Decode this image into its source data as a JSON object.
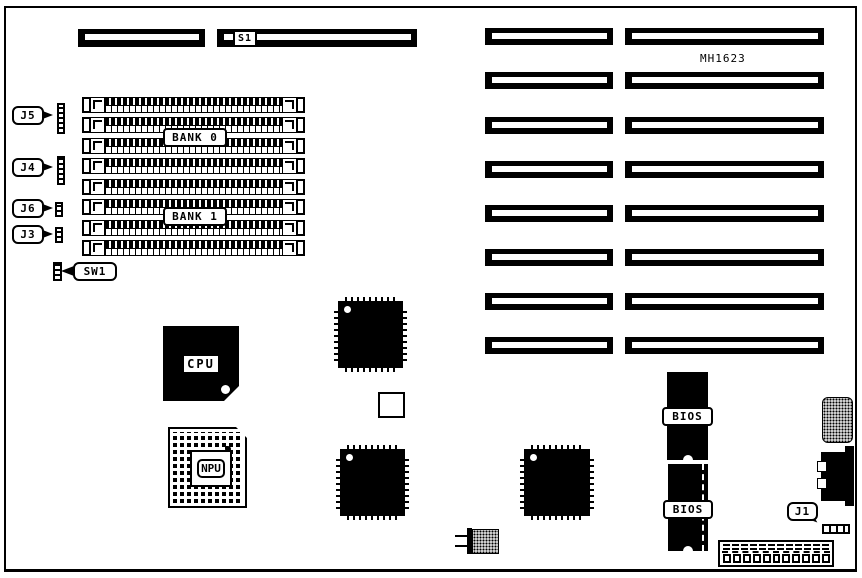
{
  "colors": {
    "ink": "#000000",
    "paper": "#ffffff"
  },
  "labels": {
    "s1": "S1",
    "mh1623": "MH1623",
    "bank0": "BANK 0",
    "bank1": "BANK 1",
    "cpu": "CPU",
    "npu": "NPU",
    "bios_top": "BIOS",
    "bios_bottom": "BIOS",
    "j5": "J5",
    "j4": "J4",
    "j6": "J6",
    "j3": "J3",
    "sw1": "SW1",
    "j1": "J1"
  },
  "structure": {
    "simm_sockets": 8,
    "expansion_slot_rows": 8,
    "expansion_slot_columns": 2,
    "memory_banks": [
      "BANK 0",
      "BANK 1"
    ],
    "bios_chips": 2
  }
}
